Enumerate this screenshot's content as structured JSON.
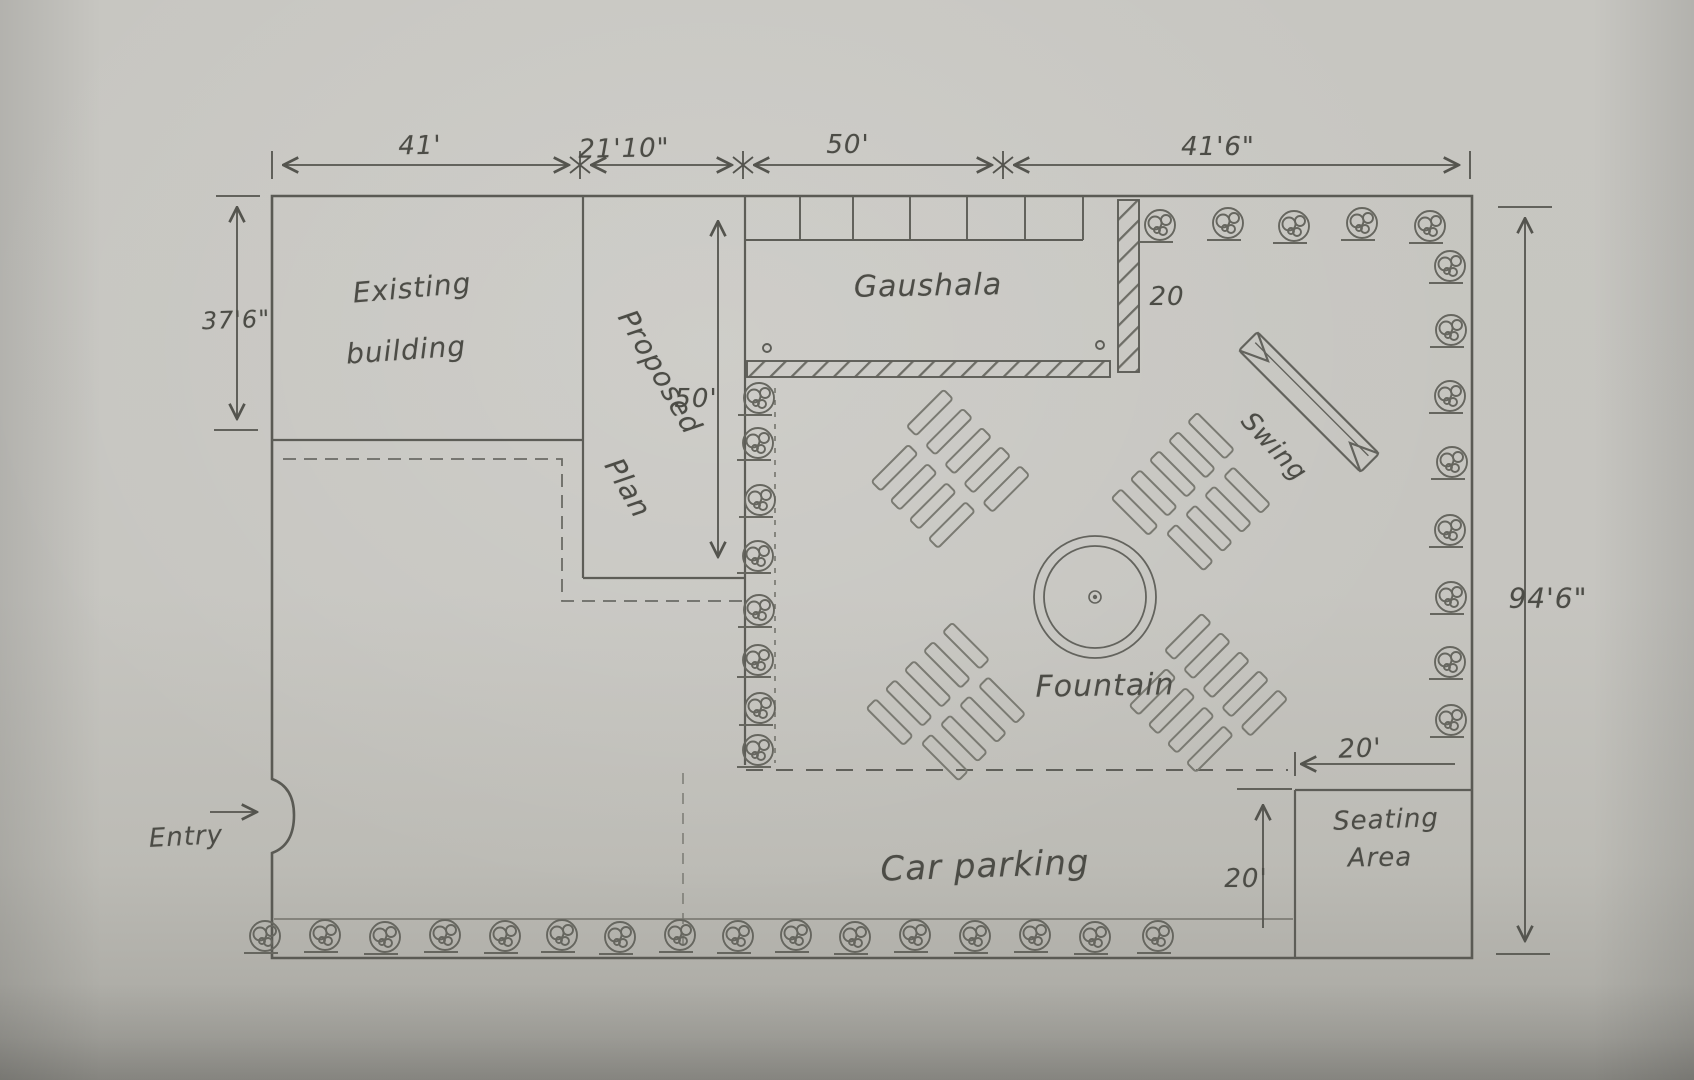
{
  "dims": {
    "top": [
      "41'",
      "21'10\"",
      "50'",
      "41'6\""
    ],
    "left_height": "37'6\"",
    "right_height": "94'6\"",
    "proposed_depth": "50'",
    "gaushala_wall_len": "20",
    "seating_width": "20'",
    "seating_depth": "20'"
  },
  "labels": {
    "existing_l1": "Existing",
    "existing_l2": "building",
    "proposed_l1": "Proposed",
    "proposed_l2": "Plan",
    "gaushala": "Gaushala",
    "swing": "Swing",
    "fountain": "Fountain",
    "car_parking": "Car parking",
    "seating_l1": "Seating",
    "seating_l2": "Area",
    "entry": "Entry"
  }
}
